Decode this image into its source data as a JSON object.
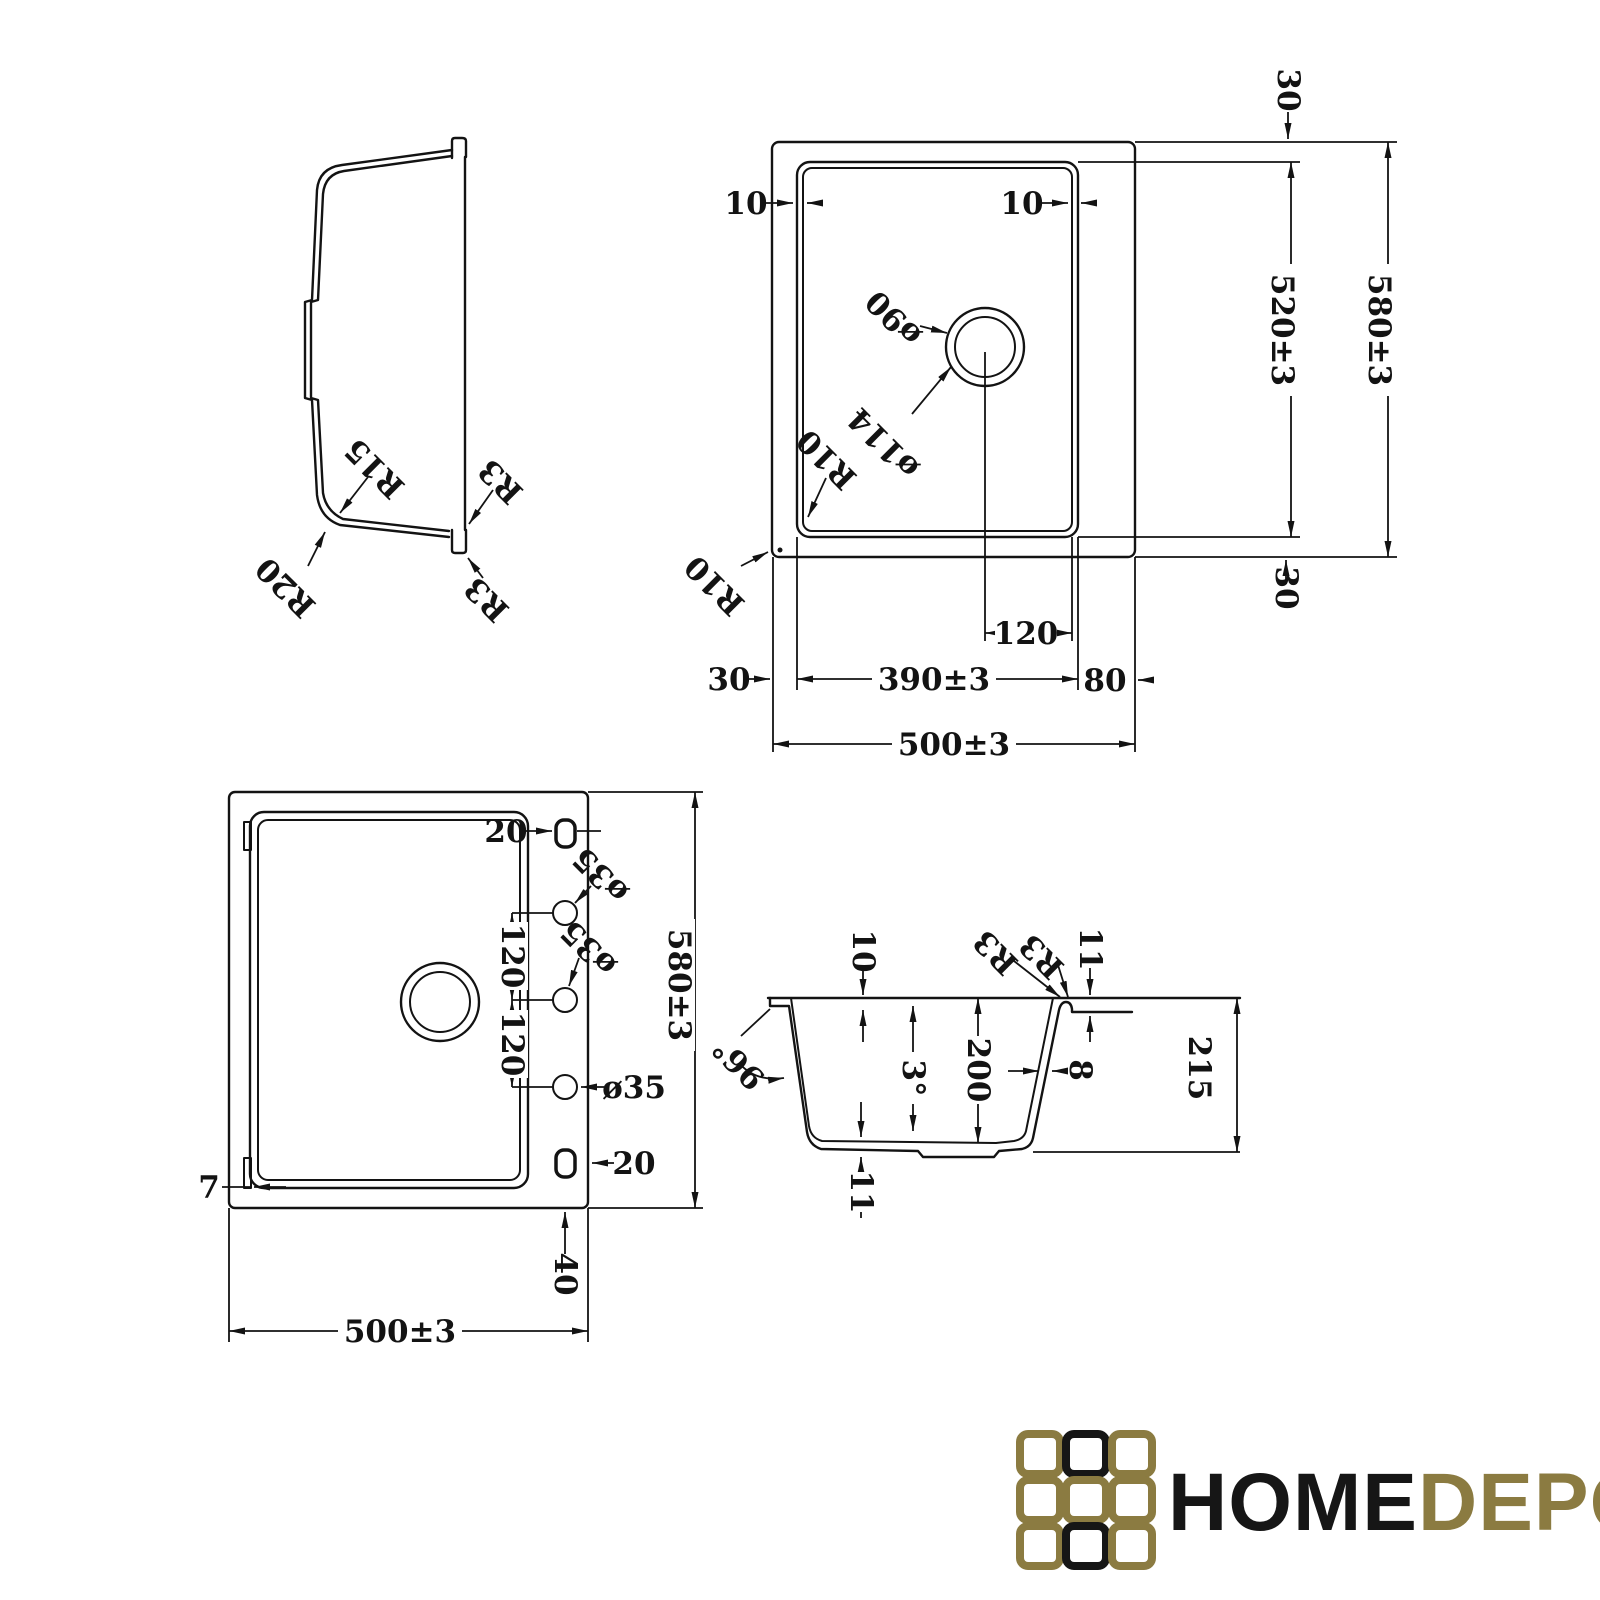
{
  "colors": {
    "ink": "#131313",
    "gold": "#8b7b41",
    "background": "#ffffff"
  },
  "side_profile_view": {
    "r15": "R15",
    "r20": "R20",
    "r3_inner": "R3",
    "r3_outer": "R3"
  },
  "top_view": {
    "reveal_left": "10",
    "reveal_right": "10",
    "drain_diameter": "ø90",
    "drain_outer_diameter": "ø114",
    "bowl_corner_radius": "R10",
    "outer_corner_radius": "R10",
    "margin_top": "30",
    "bowl_length": "520±3",
    "overall_length": "580±3",
    "margin_bottom": "30",
    "margin_left": "30",
    "drain_offset": "120",
    "bowl_width": "390±3",
    "ledge_right": "80",
    "overall_width": "500±3"
  },
  "bottom_view": {
    "slot_offset_top": "20",
    "hole_top": "ø35",
    "hole_middle": "ø35",
    "hole_bottom": "ø35",
    "hole_pitch_top": "120",
    "hole_pitch_bottom": "120",
    "overall_length": "580±3",
    "clip_width": "7",
    "slot_offset_bottom": "20",
    "edge_offset": "40",
    "overall_width": "500±3"
  },
  "section_view": {
    "flange_thickness": "10",
    "rim_fillet_left": "R3",
    "rim_fillet_right": "R3",
    "rim_thickness": "11",
    "wall_angle": "96°",
    "draft_angle": "3°",
    "bowl_depth": "200",
    "wall_thickness": "8",
    "overall_height": "215",
    "bottom_thickness": "11"
  },
  "logo": {
    "home": "HOME",
    "depo": "DEPO"
  }
}
